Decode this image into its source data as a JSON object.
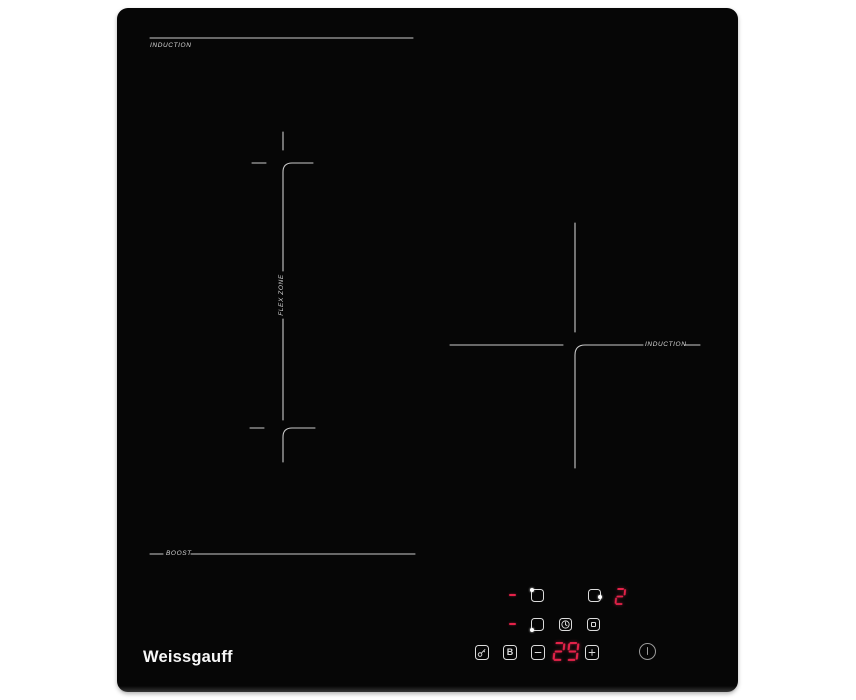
{
  "background_color": "#ffffff",
  "panel": {
    "glass_color": "#060606",
    "marking_color": "#c9c9c9"
  },
  "brand": "Weissgauff",
  "zone_labels": {
    "top_left": "INDUCTION",
    "flex": "FLEX ZONE",
    "right": "INDUCTION",
    "boost": "BOOST"
  },
  "controls": {
    "accent_red": "#e32249",
    "icon_color": "#dcdcdc",
    "right_zone_level": "2",
    "timer_value": "29",
    "boost_label": "B",
    "icons": {
      "zone_rear_left": "zone-rear-left-icon",
      "zone_right": "zone-right-icon",
      "zone_front_left": "zone-front-left-icon",
      "timer": "timer-clock-icon",
      "pause": "pause-icon",
      "lock": "key-lock-icon",
      "minus": "minus-icon",
      "plus": "plus-icon",
      "power": "power-icon"
    }
  }
}
